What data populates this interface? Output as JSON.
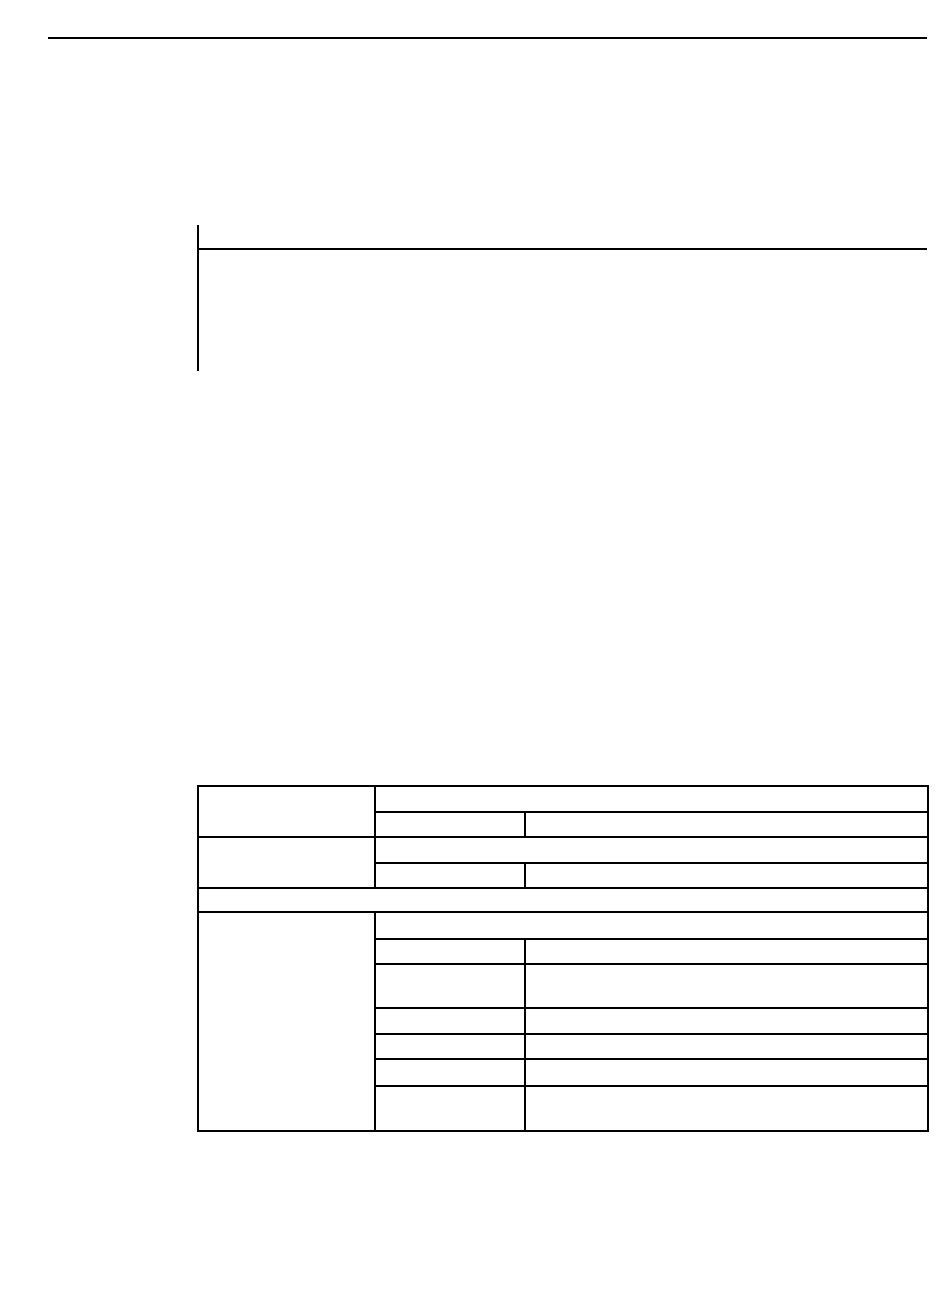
{
  "page": {
    "background_color": "#ffffff",
    "rule_color": "#000000",
    "description": "Blank document page: header rule, empty note block, empty specification table grid"
  },
  "header": {
    "text": ""
  },
  "note": {
    "text": ""
  },
  "table": {
    "group1": {
      "label": "",
      "top": "",
      "mid": "",
      "right": ""
    },
    "group2": {
      "label": "",
      "top": "",
      "mid": "",
      "right": ""
    },
    "row_full": {
      "text": ""
    },
    "group3": {
      "label": "",
      "top": "",
      "sub_rows": [
        {
          "mid": "",
          "right": ""
        },
        {
          "mid": "",
          "right": ""
        },
        {
          "mid": "",
          "right": ""
        },
        {
          "mid": "",
          "right": ""
        },
        {
          "mid": "",
          "right": ""
        },
        {
          "mid": "",
          "right": ""
        }
      ]
    }
  }
}
